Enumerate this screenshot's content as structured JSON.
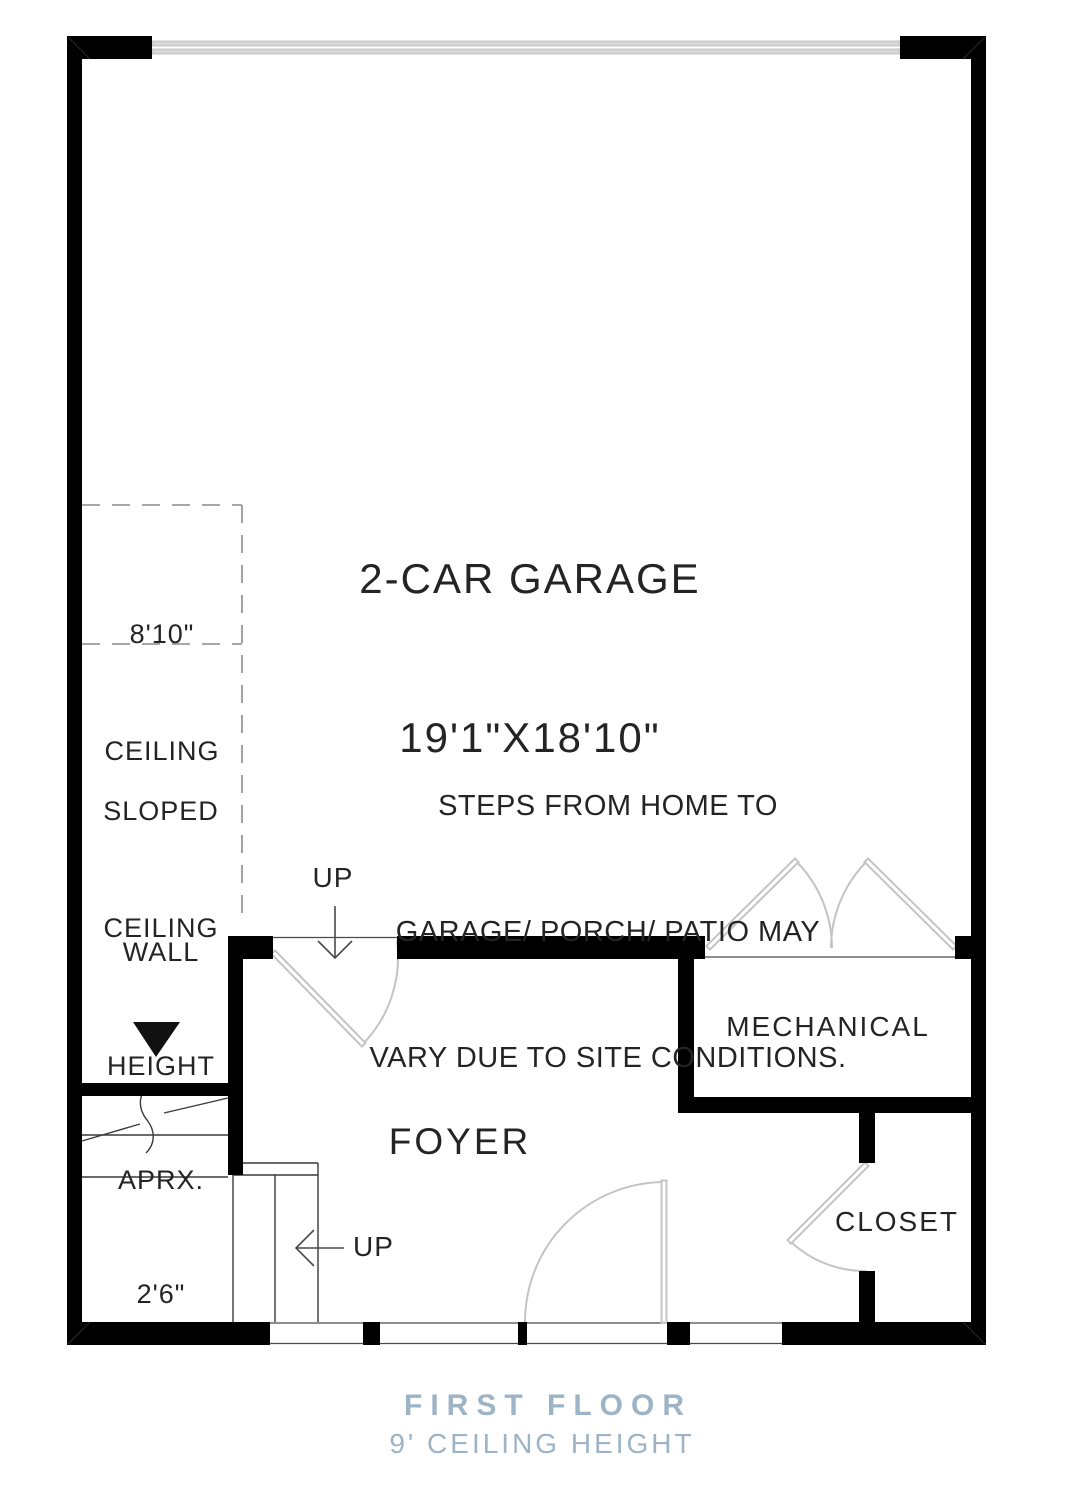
{
  "colors": {
    "wall": "#000000",
    "door_swing": "#c4c4c4",
    "garage_door": "#d6d6d6",
    "thin_line": "#4a4a4a",
    "dashed_line": "#8a8a8a",
    "accent": "#9db4c6",
    "text": "#242424"
  },
  "garage": {
    "title": "2-CAR GARAGE",
    "dims": "19'1\"X18'10\""
  },
  "note": {
    "line1": "STEPS FROM HOME TO",
    "line2": "GARAGE/ PORCH/ PATIO MAY",
    "line3": "VARY DUE TO SITE CONDITIONS."
  },
  "annotations": {
    "ceiling_810": {
      "line1": "8'10\"",
      "line2": "CEILING"
    },
    "sloped": {
      "line1": "SLOPED",
      "line2": "CEILING"
    },
    "wall_height": {
      "line1": "WALL",
      "line2": "HEIGHT",
      "line3": "APRX.",
      "line4": "2'6\""
    },
    "up_top": "UP",
    "up_bottom": "UP"
  },
  "rooms": {
    "foyer": "FOYER",
    "mechanical": "MECHANICAL",
    "closet": "CLOSET"
  },
  "footer": {
    "title": "FIRST FLOOR",
    "subtitle": "9' CEILING HEIGHT"
  }
}
